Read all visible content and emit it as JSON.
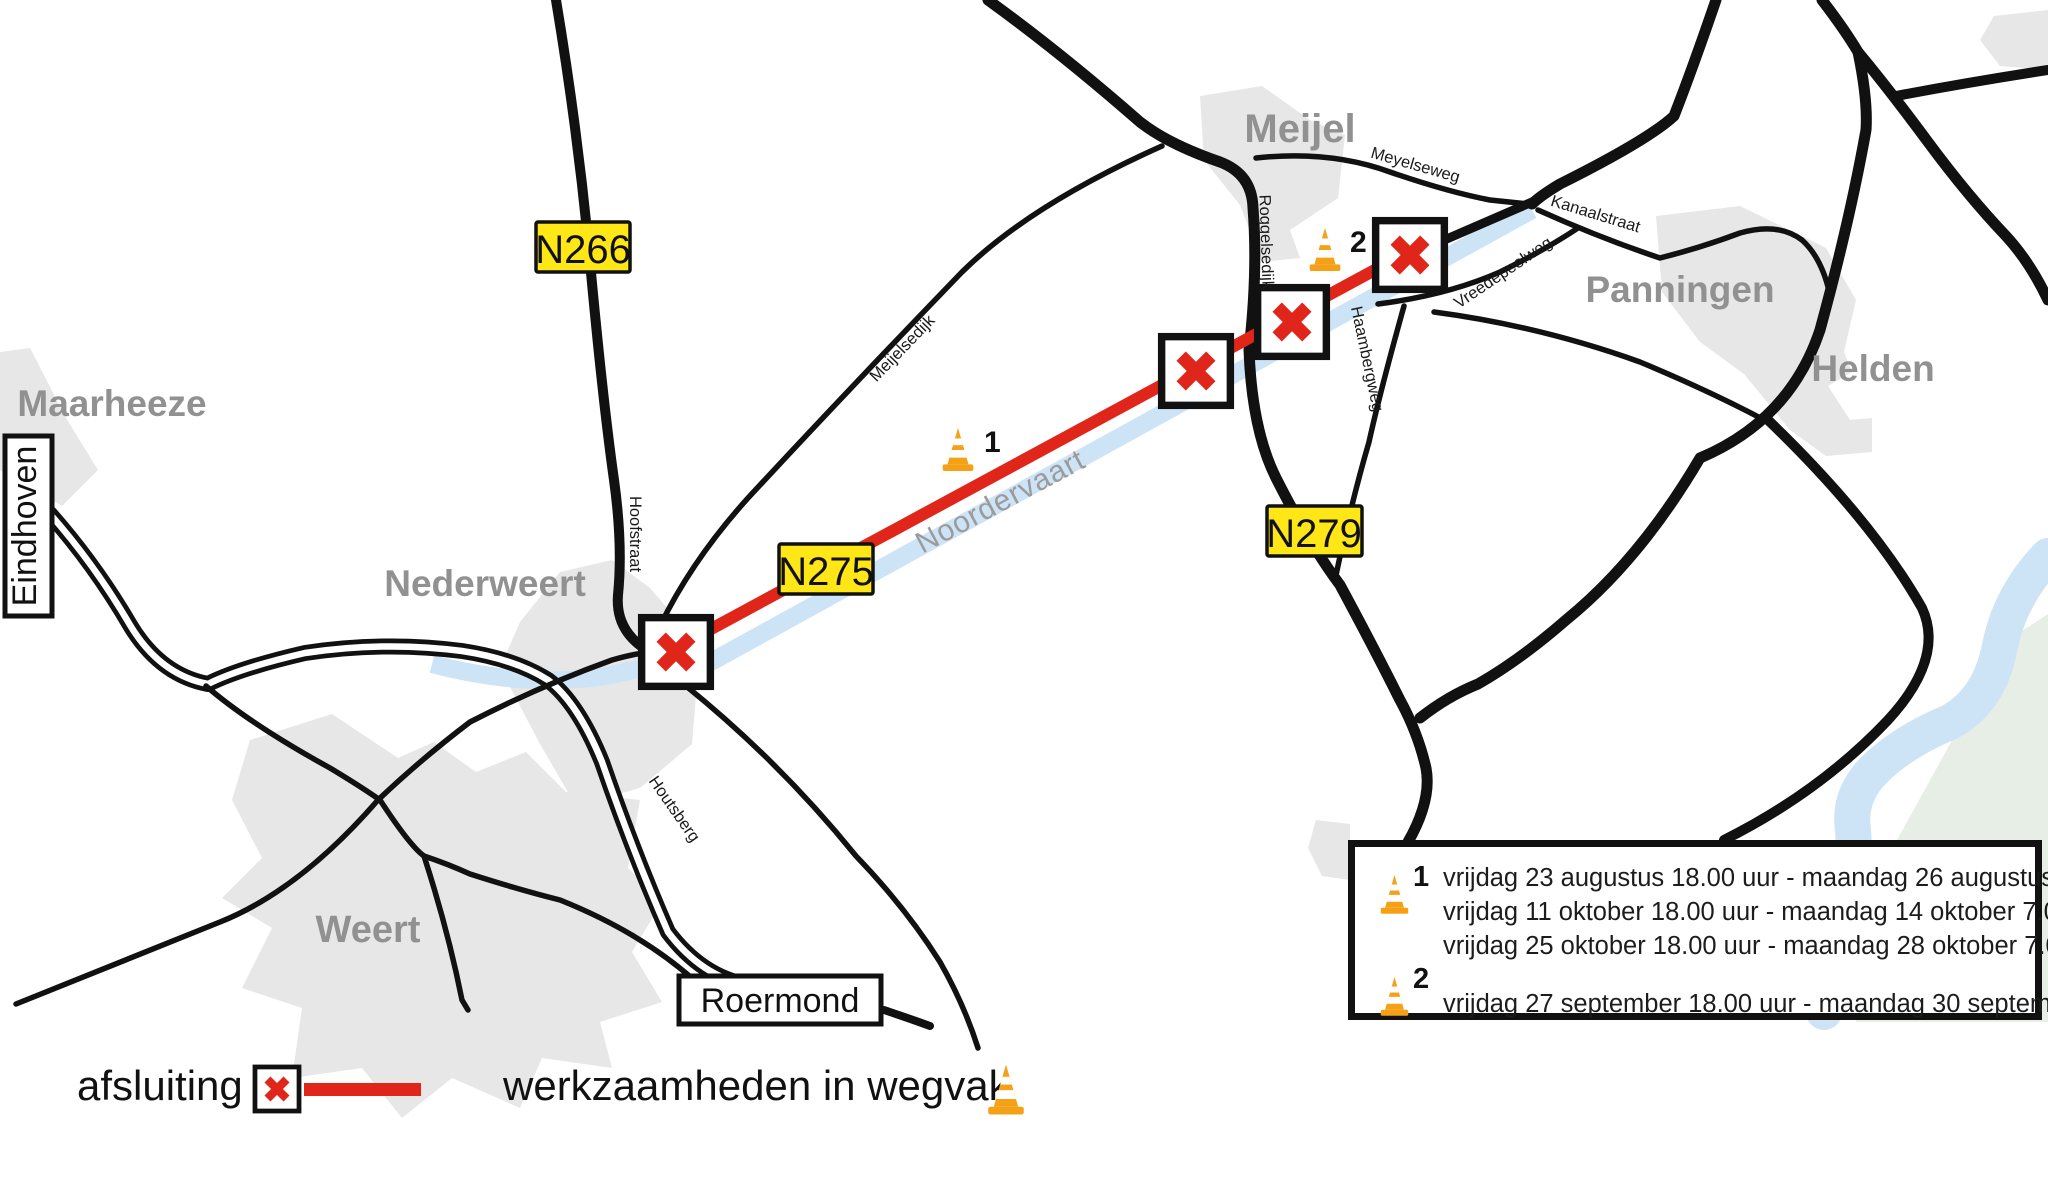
{
  "colors": {
    "closure_red": "#e0251a",
    "cone_orange": "#f5a118",
    "shield_yellow": "#ffe616",
    "canal_blue": "#cde4f6",
    "urban_gray": "#e7e7e7",
    "nature_green": "#e6eee6",
    "city_label_gray": "#919191",
    "road_black": "#111111"
  },
  "map": {
    "cities": {
      "maarheeze": "Maarheeze",
      "nederweert": "Nederweert",
      "weert": "Weert",
      "meijel": "Meijel",
      "panningen": "Panningen",
      "helden": "Helden"
    },
    "boxed": {
      "eindhoven": "Eindhoven",
      "roermond": "Roermond"
    },
    "shields": {
      "n266": "N266",
      "n275": "N275",
      "n279": "N279"
    },
    "streets": {
      "hoofstraat": "Hoofstraat",
      "houtsberg": "Houtsberg",
      "meijelsedijk": "Meijelsedijk",
      "meyelseweg": "Meyelseweg",
      "roggelsedijk": "Roggelsedijk",
      "kanaalstraat": "Kanaalstraat",
      "vreedepeelweg": "Vreedepeelweg",
      "haambergweg": "Haambergweg"
    },
    "water": {
      "noordervaart": "Noordervaart"
    },
    "work_markers": {
      "cone1_sup": "1",
      "cone2_sup": "2"
    }
  },
  "schedule_box": {
    "entries": [
      {
        "sup": "1",
        "lines": [
          "vrijdag 23 augustus 18.00 uur - maandag 26 augustus 7.00 uur.",
          "vrijdag 11 oktober 18.00 uur - maandag 14 oktober 7.00 uur.",
          "vrijdag 25 oktober 18.00 uur - maandag 28 oktober 7.00 uur."
        ]
      },
      {
        "sup": "2",
        "lines": [
          "vrijdag 27 september 18.00 uur - maandag 30 september 7.00 uur."
        ]
      }
    ]
  },
  "legend": {
    "closure": "afsluiting",
    "works": "werkzaamheden in wegvak"
  }
}
